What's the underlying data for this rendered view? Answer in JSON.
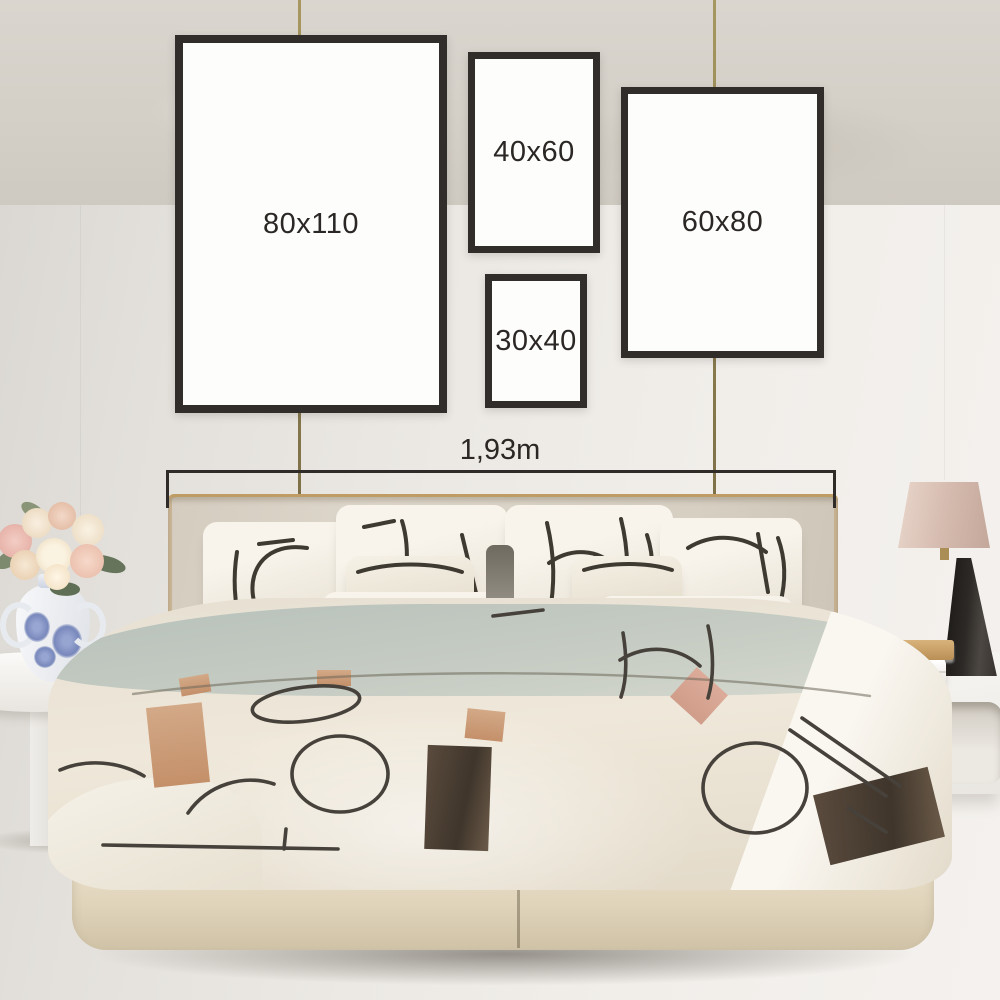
{
  "size_guide": {
    "frames": [
      {
        "label": "80x110"
      },
      {
        "label": "40x60"
      },
      {
        "label": "60x80"
      },
      {
        "label": "30x40"
      }
    ],
    "bed_width_label": "1,93m"
  },
  "colors": {
    "frame_border": "#312d2a",
    "overlay_text": "#2b2724",
    "hanging_wire": "#95855a",
    "wall_left": "#d9d6d1",
    "wall_right": "#f4f1ee",
    "headboard": "#d6cfc2",
    "headboard_trim_gold": "#bf9c63",
    "pillow_white": "#f4f0e8",
    "duvet_cream": "#ece5d7",
    "duvet_sage": "#c2c9c1",
    "pattern_line": "#46413a",
    "pattern_tan": "#c89a77",
    "pattern_salmon": "#d8a794",
    "pattern_brown": "#53463a",
    "bed_base": "#e3d8c2",
    "floor": "#d5d1c9",
    "lamp_shade": "#d9bcb0",
    "lamp_base": "#26231f",
    "vase_blue": "#6a7cb4",
    "rose_pink": "#eac3ba",
    "rose_cream": "#f4e9d6",
    "leaf_green": "#7d8a6d"
  }
}
